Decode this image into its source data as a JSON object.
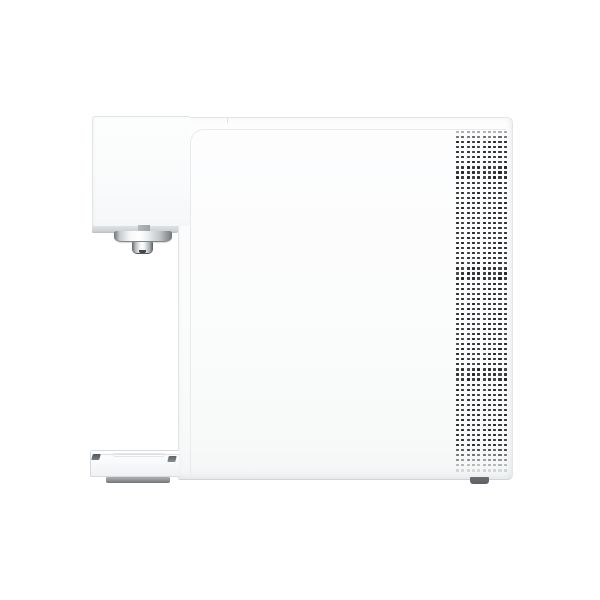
{
  "meta": {
    "type": "product-photo",
    "subject": "White countertop water purifier, side profile view",
    "background_color": "#ffffff"
  },
  "colors": {
    "bg": "#ffffff",
    "body-white": "#fbfcfd",
    "edge": "#e2e5e7",
    "edge-dark": "#d2d5d8",
    "seam": "#e8ebed",
    "underside": "#ced2d5",
    "chrome-dark": "#6e7376",
    "chrome-light": "#f7f8f9",
    "hole": "#212427",
    "foot": "#5d6165",
    "tray-base": "#909497"
  },
  "product": {
    "name": "water-purifier-side-view",
    "parts": [
      "head-unit",
      "faucet-spout",
      "body-panel",
      "vent-grille",
      "drip-tray"
    ],
    "vent": {
      "columns": 10,
      "rows": 68,
      "hole_width": 3.2,
      "hole_height": 2.2,
      "pitch_x": 5.3,
      "pitch_y": 5.05,
      "hole_color": "#212427",
      "fade_top_rows": 2,
      "fade_bottom_start_row": 62
    }
  }
}
